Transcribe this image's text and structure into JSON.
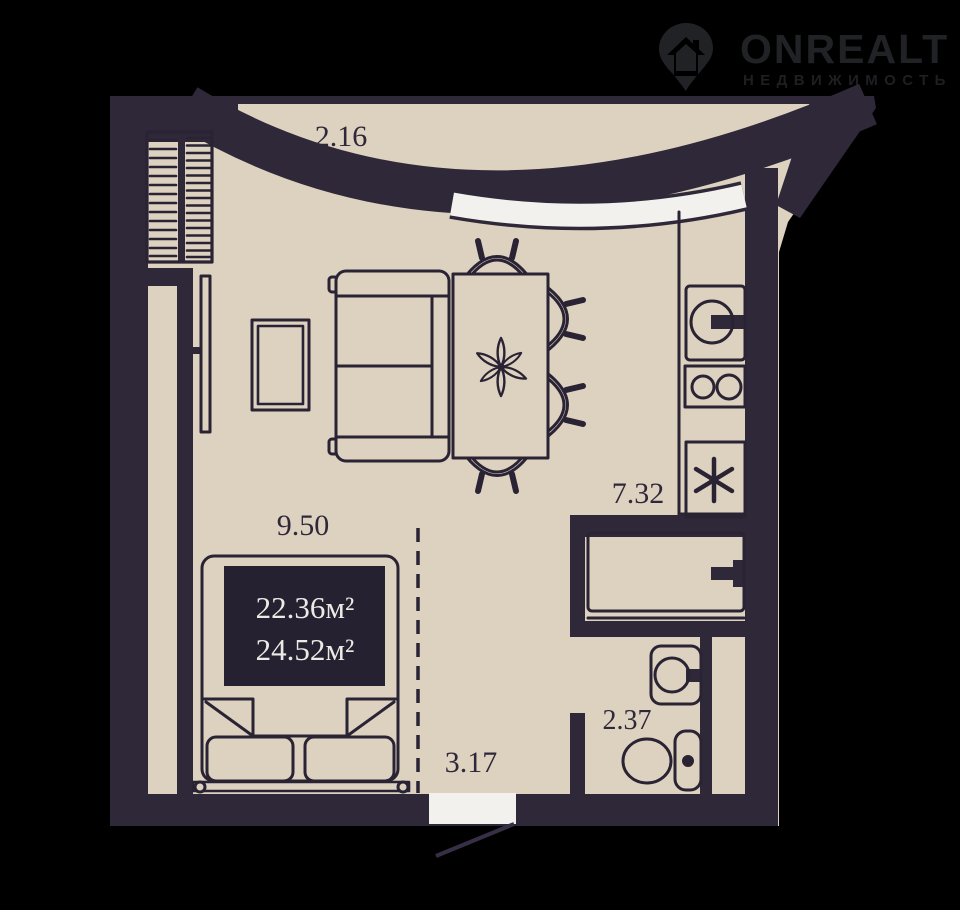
{
  "logo": {
    "brand": "ONREALT",
    "tagline": "НЕДВИЖИМОСТЬ"
  },
  "floor_plan": {
    "dimension_labels": {
      "balcony_width": "2.16",
      "living_room_width": "9.50",
      "kitchen_zone": "7.32",
      "hallway": "3.17",
      "bathroom": "2.37"
    },
    "area_labels": {
      "living_area": "22.36м²",
      "total_area": "24.52м²"
    }
  },
  "colors": {
    "background": "#000000",
    "floor": "#ddd1c0",
    "walls": "#2f2839",
    "outline": "#292334",
    "accent_white": "#f2f1ed",
    "area_box": "#262131",
    "area_text": "#eceae4",
    "door_swing": "#372f45",
    "logo": "#212226",
    "logo_tagline": "#1e1f23"
  }
}
